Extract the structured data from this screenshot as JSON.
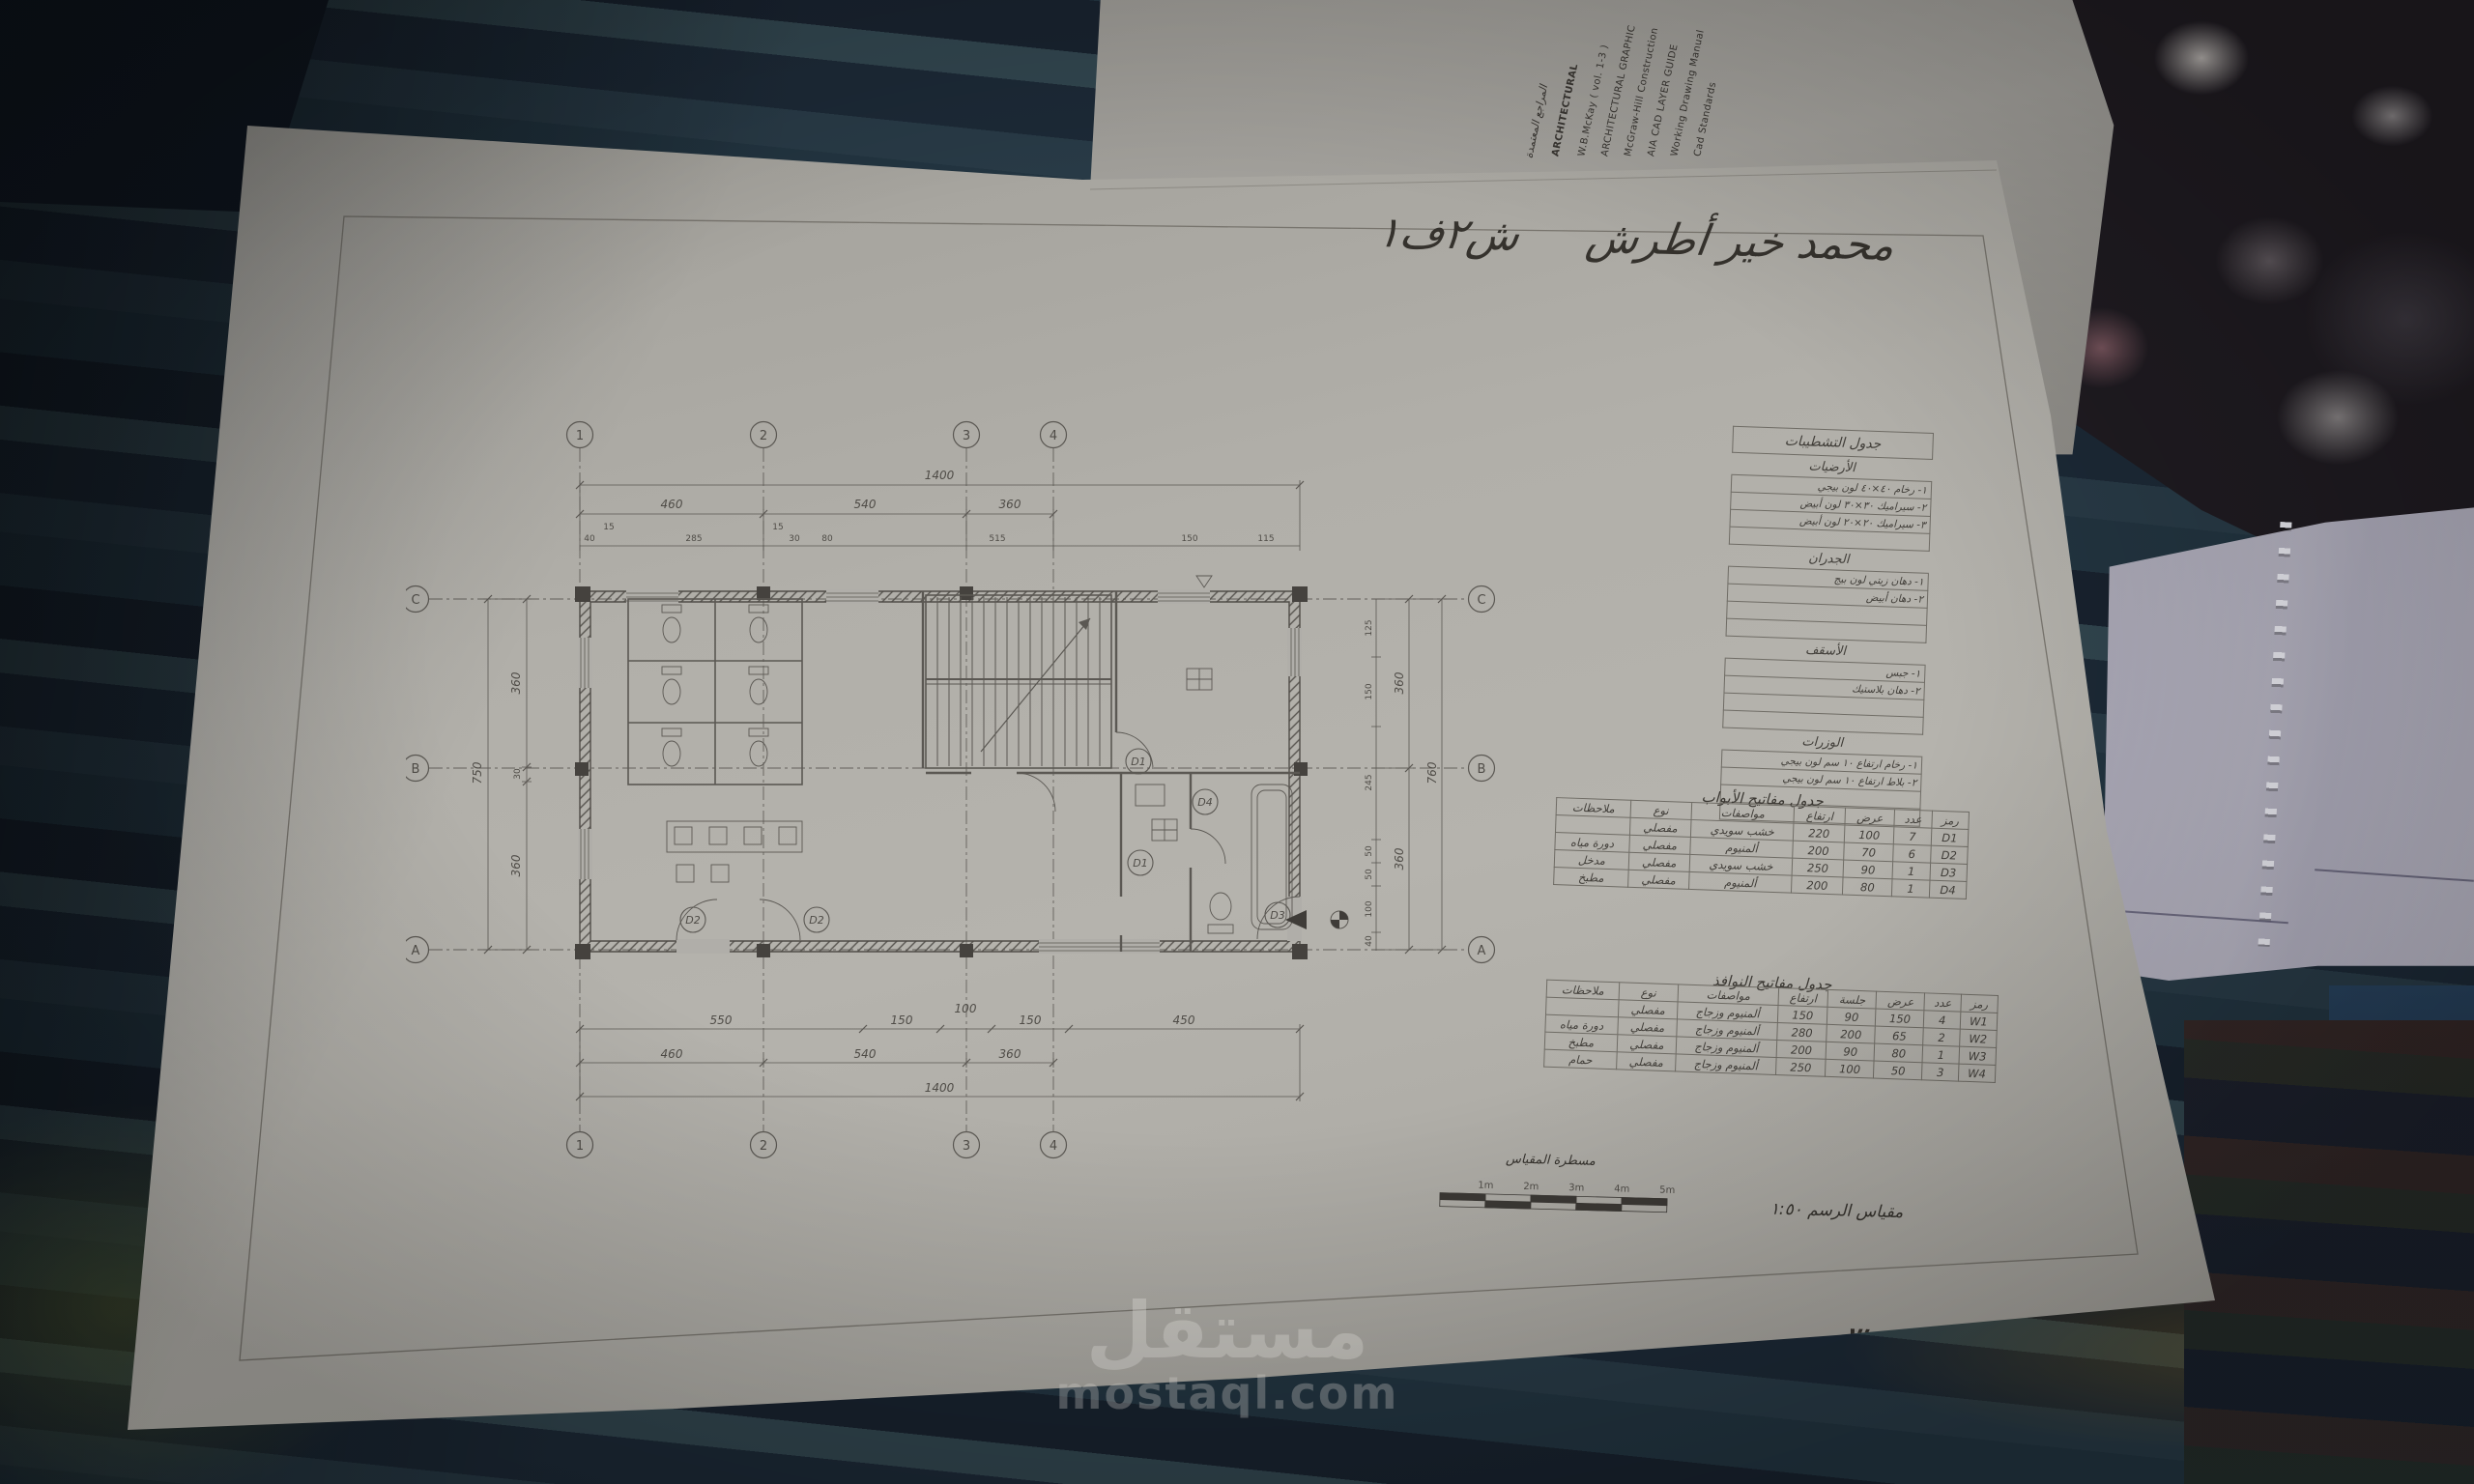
{
  "sheet": {
    "author_note": {
      "name": "محمد خير أطرش",
      "class": "ش٢ف١"
    },
    "exercise": "تمرين ٣",
    "scale": {
      "ruler_label": "مسطرة المقياس",
      "ticks": [
        "1m",
        "2m",
        "3m",
        "4m",
        "5m"
      ],
      "text": "مقياس الرسم ١:٥٠"
    },
    "watermark": {
      "ar": "مستقل",
      "en": "mostaql.com"
    },
    "grid": {
      "cols": [
        "1",
        "2",
        "3",
        "4"
      ],
      "rows": [
        "C",
        "B",
        "A"
      ]
    },
    "dims": {
      "top": {
        "overall": "1400",
        "spans": [
          "460",
          "540",
          "360"
        ],
        "details": [
          "40",
          "15",
          "285",
          "15",
          "30",
          "80",
          "515",
          "150",
          "115"
        ]
      },
      "bottom": {
        "overall": "1400",
        "spans": [
          "460",
          "540",
          "360"
        ],
        "details": [
          "550",
          "150",
          "100",
          "150",
          "450"
        ]
      },
      "left": {
        "overall": "750",
        "spans": [
          "360",
          "30",
          "360"
        ]
      },
      "right": {
        "overall": "760",
        "spans": [
          "360",
          "360"
        ],
        "details": [
          "125",
          "150",
          "245",
          "50",
          "50",
          "100",
          "40"
        ]
      }
    },
    "plan": {
      "door_marks": [
        "D2",
        "D2",
        "D1",
        "D1",
        "D4",
        "D3"
      ]
    },
    "finishes_table": {
      "title": "جدول التشطيبات",
      "sections": [
        {
          "name": "الأرضيات",
          "items": [
            "١- رخام ٤٠×٤٠ لون بيجي",
            "٢- سيراميك ٣٠×٣٠ لون أبيض",
            "٣- سيراميك ٢٠×٢٠ لون أبيض",
            ""
          ]
        },
        {
          "name": "الجدران",
          "items": [
            "١- دهان زيتي لون بيج",
            "٢- دهان أبيض",
            "",
            ""
          ]
        },
        {
          "name": "الأسقف",
          "items": [
            "١- جبس",
            "٢- دهان بلاستيك",
            "",
            ""
          ]
        },
        {
          "name": "الوزرات",
          "items": [
            "١- رخام ارتفاع ١٠ سم لون بيجي",
            "٢- بلاط ارتفاع ١٠ سم لون بيجي",
            "",
            ""
          ]
        }
      ]
    },
    "doors_table": {
      "title": "جدول مفاتيح الأبواب",
      "headers": {
        "code": "رمز",
        "count": "عدد",
        "width": "عرض",
        "height": "ارتفاع",
        "spec": "مواصفات",
        "type": "نوع",
        "notes": "ملاحظات"
      },
      "rows": [
        {
          "code": "D1",
          "count": "7",
          "width": "100",
          "height": "220",
          "spec": "خشب سويدي",
          "type": "مفصلي",
          "notes": ""
        },
        {
          "code": "D2",
          "count": "6",
          "width": "70",
          "height": "200",
          "spec": "ألمنيوم",
          "type": "مفصلي",
          "notes": "دورة مياه"
        },
        {
          "code": "D3",
          "count": "1",
          "width": "90",
          "height": "250",
          "spec": "خشب سويدي",
          "type": "مفصلي",
          "notes": "مدخل"
        },
        {
          "code": "D4",
          "count": "1",
          "width": "80",
          "height": "200",
          "spec": "ألمنيوم",
          "type": "مفصلي",
          "notes": "مطبخ"
        }
      ]
    },
    "windows_table": {
      "title": "جدول مفاتيح النوافذ",
      "headers": {
        "code": "رمز",
        "count": "عدد",
        "width": "عرض",
        "sill": "جلسة",
        "height": "ارتفاع",
        "spec": "مواصفات",
        "type": "نوع",
        "notes": "ملاحظات"
      },
      "rows": [
        {
          "code": "W1",
          "count": "4",
          "width": "150",
          "sill": "90",
          "height": "150",
          "spec": "ألمنيوم وزجاج",
          "type": "مفصلي",
          "notes": ""
        },
        {
          "code": "W2",
          "count": "2",
          "width": "65",
          "sill": "200",
          "height": "280",
          "spec": "ألمنيوم وزجاج",
          "type": "مفصلي",
          "notes": "دورة مياه"
        },
        {
          "code": "W3",
          "count": "1",
          "width": "80",
          "sill": "90",
          "height": "200",
          "spec": "ألمنيوم وزجاج",
          "type": "مفصلي",
          "notes": "مطبخ"
        },
        {
          "code": "W4",
          "count": "3",
          "width": "50",
          "sill": "100",
          "height": "250",
          "spec": "ألمنيوم وزجاج",
          "type": "مفصلي",
          "notes": "حمام"
        }
      ]
    }
  },
  "background": {
    "references_sheet": {
      "lines": [
        "المراجع المعتمدة",
        "ARCHITECTURAL",
        "W.B.McKay ( vol. 1-3 )",
        "ARCHITECTURAL GRAPHIC",
        "McGraw-Hill Construction",
        "AIA CAD LAYER GUIDE",
        "Working Drawing Manual",
        "Cad Standards"
      ]
    }
  },
  "colors": {
    "paper": "#b2b0aa",
    "pencil": "#4f4c47",
    "ink": "#35322d",
    "fabric": "#22303c",
    "blanket": "#1f1b21",
    "watermark": "#efede8"
  }
}
